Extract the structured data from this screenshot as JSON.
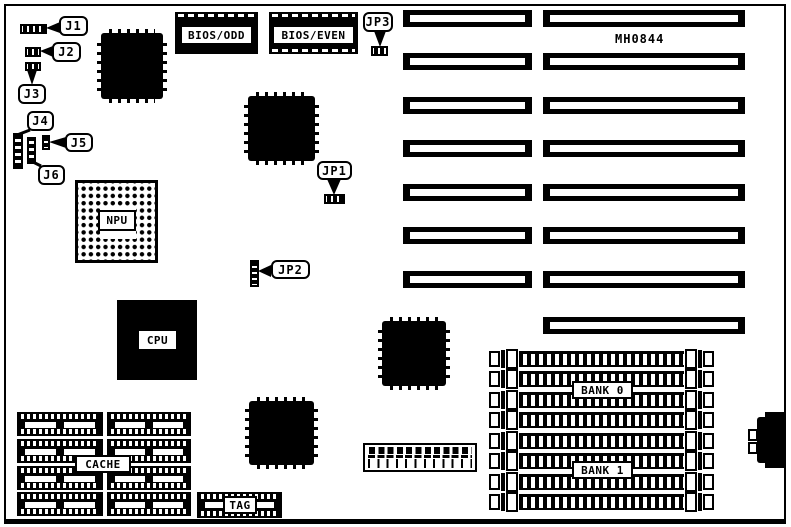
{
  "board": {
    "id_text": "MH0844"
  },
  "jumpers": {
    "j1": "J1",
    "j2": "J2",
    "j3": "J3",
    "j4": "J4",
    "j5": "J5",
    "j6": "J6",
    "jp1": "JP1",
    "jp2": "JP2",
    "jp3": "JP3"
  },
  "chips": {
    "bios_odd": "BIOS/ODD",
    "bios_even": "BIOS/EVEN",
    "npu": "NPU",
    "cpu": "CPU",
    "cache": "CACHE",
    "tag": "TAG"
  },
  "memory": {
    "bank0": "BANK 0",
    "bank1": "BANK 1"
  },
  "colors": {
    "ink": "#000000",
    "paper": "#ffffff"
  }
}
